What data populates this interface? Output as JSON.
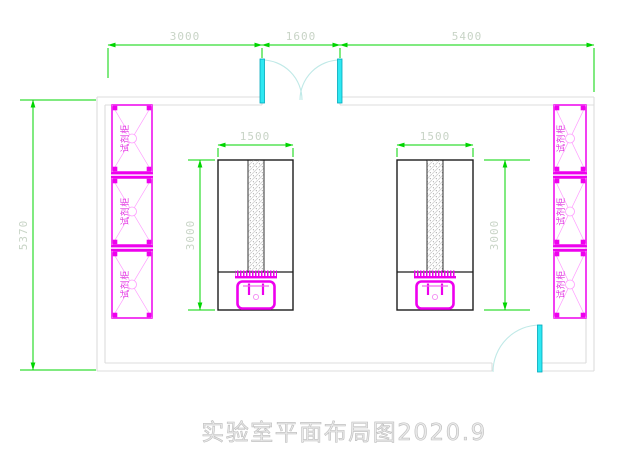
{
  "drawing": {
    "title": "实验室平面布局图2020.9"
  },
  "dims": {
    "top_segments": [
      {
        "label": "3000"
      },
      {
        "label": "1600"
      },
      {
        "label": "5400"
      }
    ],
    "overall_height": {
      "label": "5370"
    },
    "left_bench": {
      "width": "1500",
      "depth": "3000"
    },
    "right_bench": {
      "width": "1500",
      "depth": "3000"
    }
  },
  "cabinets": {
    "label": "试剂柜",
    "left_count": 3,
    "right_count": 3
  },
  "colors": {
    "dimension_line": "#00d500",
    "dimension_text": "#c8d4c6",
    "cabinet_magenta": "#ee00ee",
    "door_cyan": "#2ee8f2",
    "door_arc": "#bfe9e7",
    "wall_gray": "#dcdcdc",
    "bench_black": "#1c1c1c",
    "title_gray": "#cccccc"
  }
}
